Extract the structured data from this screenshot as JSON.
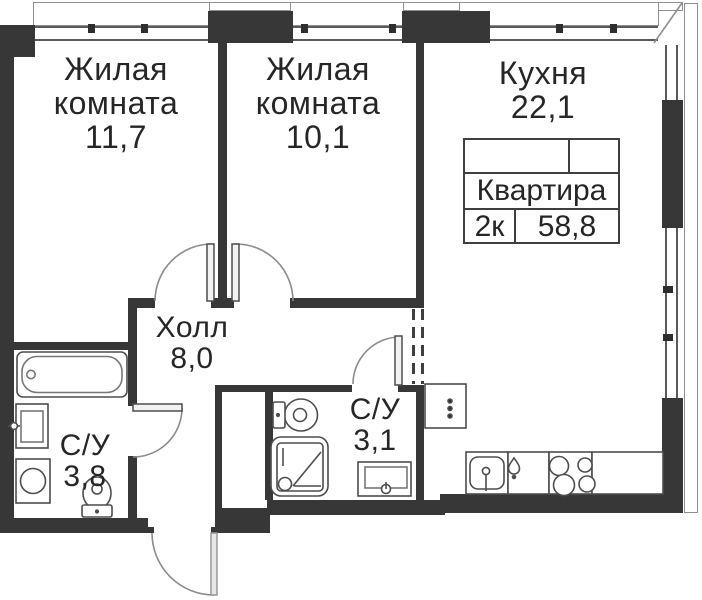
{
  "plan_title": "Floor plan — 2-room apartment",
  "rooms": {
    "living1": {
      "line1": "Жилая",
      "line2": "комната",
      "area": "11,7"
    },
    "living2": {
      "line1": "Жилая",
      "line2": "комната",
      "area": "10,1"
    },
    "kitchen": {
      "line1": "Кухня",
      "area": "22,1"
    },
    "hall": {
      "line1": "Холл",
      "area": "8,0"
    },
    "bath1": {
      "line1": "С/У",
      "area": "3,8"
    },
    "bath2": {
      "line1": "С/У",
      "area": "3,1"
    }
  },
  "info_table": {
    "title": "Квартира",
    "type": "2к",
    "total_area": "58,8"
  },
  "icons": {
    "fixtures": [
      "bathtub-icon",
      "sink-icon",
      "washing-machine-icon",
      "toilet-icon",
      "shower-icon",
      "kitchen-sink-icon",
      "faucet-drop-icon",
      "stove-icon",
      "vent-box-icon"
    ],
    "doors": [
      "door-arc",
      "door-leaf"
    ]
  },
  "colors": {
    "wall": "#373737",
    "fixture_line": "#4d4d4d",
    "door_arc": "#8c8c8c",
    "text": "#262626"
  }
}
